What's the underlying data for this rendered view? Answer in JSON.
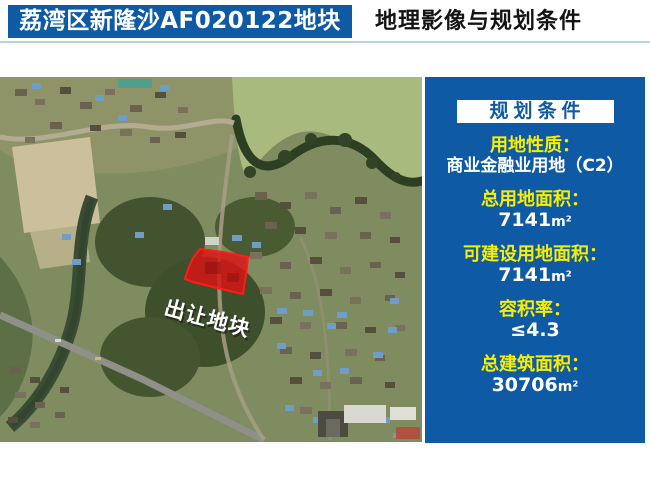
{
  "header": {
    "parcel_title": "荔湾区新隆沙AF020122地块",
    "page_title": "地理影像与规划条件"
  },
  "map": {
    "parcel_label": "出让地块"
  },
  "panel": {
    "title": "规划条件",
    "items": [
      {
        "label": "用地性质：",
        "value": "商业金融业用地（C2）",
        "unit": ""
      },
      {
        "label": "总用地面积：",
        "value": "7141",
        "unit": "m²"
      },
      {
        "label": "可建设用地面积：",
        "value": "7141",
        "unit": "m²"
      },
      {
        "label": "容积率：",
        "value": "≤4.3",
        "unit": ""
      },
      {
        "label": "总建筑面积：",
        "value": "30706",
        "unit": "m²"
      }
    ]
  },
  "colors": {
    "primary_blue": "#0e5aa5",
    "label_yellow": "#f8ee00",
    "parcel_red": "#dc1212",
    "divider_blue": "#b8d3e6"
  }
}
